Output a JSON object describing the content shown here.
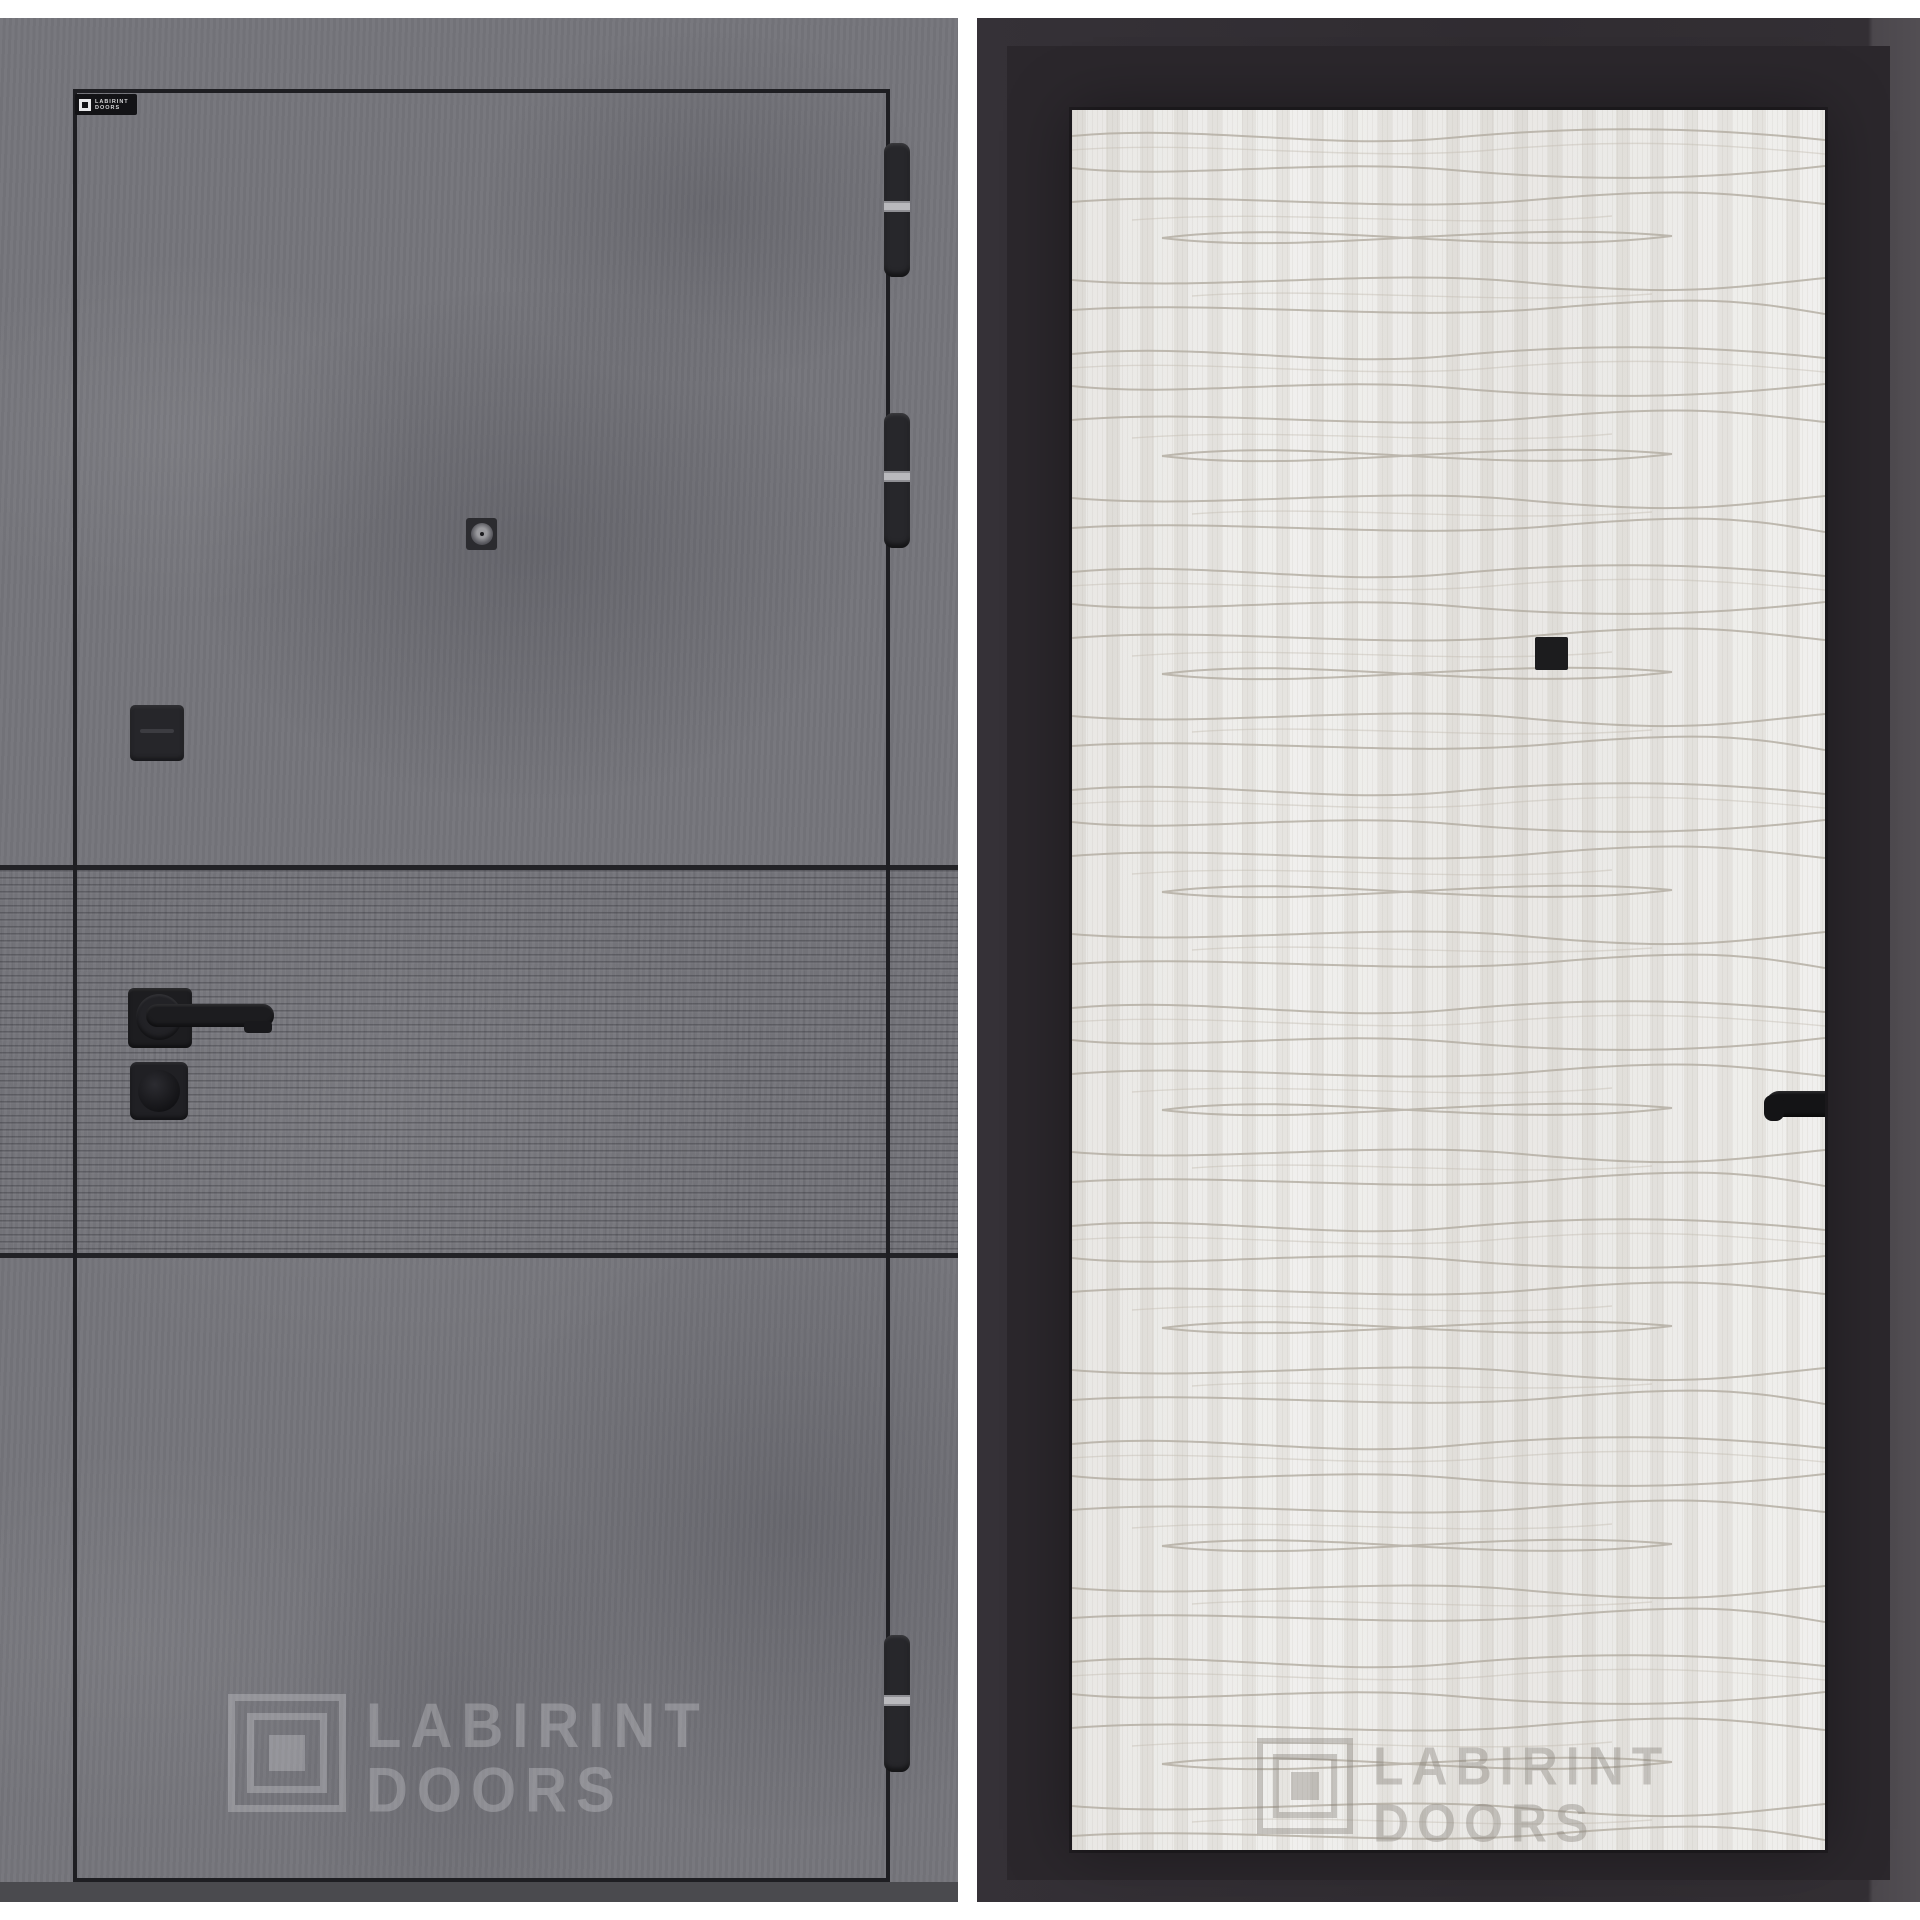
{
  "background_color": "#ffffff",
  "left_door": {
    "finish": "dark concrete with horizontal milled band",
    "brand_badge": {
      "line1": "LABIRINT",
      "line2": "DOORS"
    },
    "watermark": {
      "line1": "LABIRINT",
      "line2": "DOORS"
    },
    "colors": {
      "concrete": "#75757b",
      "outline": "#1e1e22",
      "stripe_line": "#222226",
      "hardware_black": "#1d1d20",
      "hinge_silver": "#b9b9bd",
      "floor_shadow": "#4a4a4e"
    }
  },
  "right_door": {
    "finish": "white sandal wood panel with wavy grooves",
    "watermark": {
      "line1": "LABIRINT",
      "line2": "DOORS"
    },
    "colors": {
      "frame_dark": "#302c31",
      "frame_light": "#4b474c",
      "panel_white": "#eae9e6",
      "wave_line": "#b2aba0",
      "hardware_black": "#19191c"
    }
  }
}
